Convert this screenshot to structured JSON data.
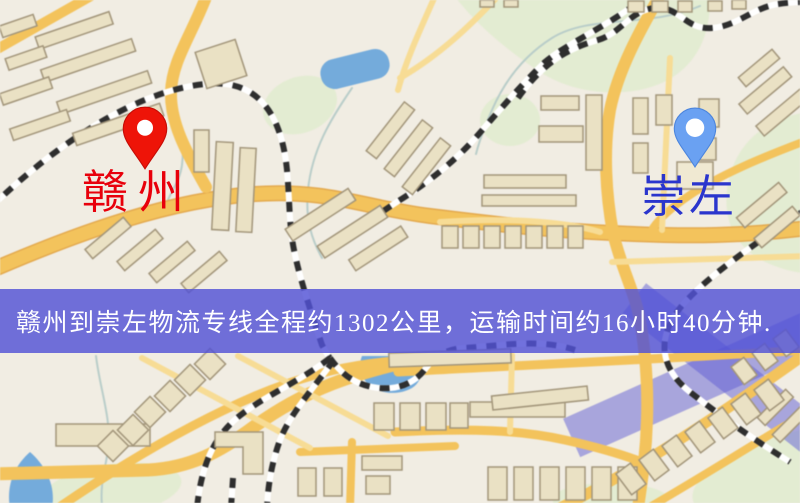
{
  "banner": {
    "text": "赣州到崇左物流专线全程约1302公里，运输时间约16小时40分钟.",
    "background": "rgba(82,82,214,0.82)",
    "text_color": "#ffffff"
  },
  "origin": {
    "name": "赣州",
    "label_color": "#e8000b",
    "pin_color": "#ee1408",
    "pin_stroke": "#c60d06"
  },
  "destination": {
    "name": "崇左",
    "label_color": "#2a35cd",
    "pin_color": "#6aa1f2",
    "pin_stroke": "#4c85dd"
  },
  "map": {
    "theme": {
      "bg": "#f1ede3",
      "park": "#e3ecd2",
      "water": "#74abdb",
      "road": "#f3c35c",
      "road_minor": "#f7dc95",
      "road_casing": "#e3a94e",
      "building": "#eae1c4",
      "building_stroke": "#a2957a",
      "building_pale": "#f0e9d2",
      "railway": "#2e2e2e",
      "railway_base": "#ffffff",
      "stream": "#b9cdc9",
      "overlay_band": "rgba(96,94,214,0.5)"
    }
  }
}
